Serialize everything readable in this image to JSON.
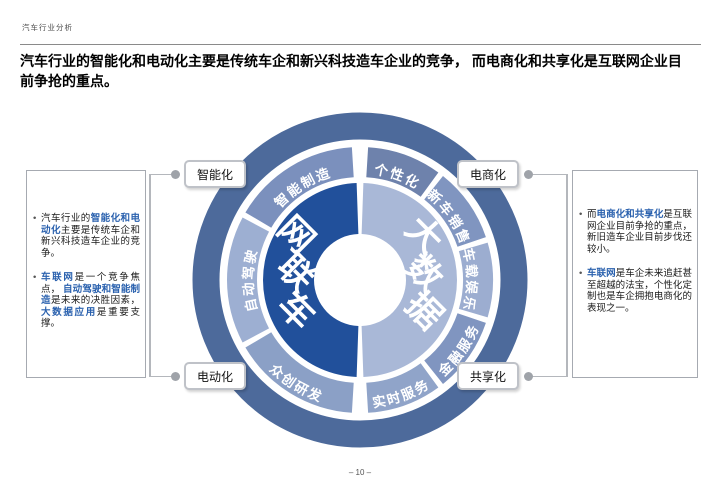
{
  "page": {
    "header": "汽车行业分析",
    "title": "汽车行业的智能化和电动化主要是传统车企和新兴科技造车企业的竞争， 而电商化和共享化是互联网企业目前争抢的重点。",
    "page_number": "– 10 –"
  },
  "colors": {
    "highlight_blue": "#2a61ae",
    "outer_ring": "#4d6a9b",
    "inner_left": "#21509b",
    "inner_right": "#a9b8d7",
    "connector": "#b4b7bc"
  },
  "left_panel": {
    "bullets": [
      [
        {
          "t": "汽车行业的",
          "h": false
        },
        {
          "t": "智能化和电动化",
          "h": true
        },
        {
          "t": "主要是传统车企和新兴科技造车企业的竞争。",
          "h": false
        }
      ],
      [
        {
          "t": "车联网",
          "h": true
        },
        {
          "t": "是一个竞争焦点， ",
          "h": false
        },
        {
          "t": "自动驾驶和智能制造",
          "h": true
        },
        {
          "t": "是未来的决胜因素， ",
          "h": false
        },
        {
          "t": "大数据应用",
          "h": true
        },
        {
          "t": "是重要支撑。",
          "h": false
        }
      ]
    ]
  },
  "right_panel": {
    "bullets": [
      [
        {
          "t": "而",
          "h": false
        },
        {
          "t": "电商化和共享化",
          "h": true
        },
        {
          "t": "是互联网企业目前争抢的重点，新旧造车企业目前步伐还较小。",
          "h": false
        }
      ],
      [
        {
          "t": "车联网",
          "h": true
        },
        {
          "t": "是车企未来追赶甚至超越的法宝，个性化定制也是车企拥抱电商化的表现之一。",
          "h": false
        }
      ]
    ]
  },
  "callouts": {
    "top_left": "智能化",
    "top_right": "电商化",
    "bottom_left": "电动化",
    "bottom_right": "共享化"
  },
  "diagram": {
    "inner_left_label": "车联网",
    "inner_right_label": "大数据",
    "left_segments": [
      {
        "label": "智能制造",
        "color": "#7b90bd",
        "start": 300.5,
        "end": 356.5,
        "flip": false
      },
      {
        "label": "自动驾驶",
        "color": "#9dafd2",
        "start": 242.0,
        "end": 298.0,
        "flip": false
      },
      {
        "label": "众创研发",
        "color": "#8ba0c6",
        "start": 183.5,
        "end": 239.5,
        "flip": true
      }
    ],
    "right_segments": [
      {
        "label": "个性化",
        "color": "#6e82ac",
        "start": 3.5,
        "end": 36.1,
        "flip": false
      },
      {
        "label": "新车销售",
        "color": "#8095c0",
        "start": 38.6,
        "end": 71.2,
        "flip": false
      },
      {
        "label": "车载娱乐",
        "color": "#9cadd0",
        "start": 73.7,
        "end": 106.3,
        "flip": false
      },
      {
        "label": "金融服务",
        "color": "#8095c0",
        "start": 108.8,
        "end": 141.4,
        "flip": true
      },
      {
        "label": "实时服务",
        "color": "#90a4c9",
        "start": 143.9,
        "end": 176.5,
        "flip": true
      }
    ],
    "inner_left_range": {
      "start": 182,
      "end": 358
    },
    "inner_right_range": {
      "start": 2,
      "end": 178
    }
  }
}
